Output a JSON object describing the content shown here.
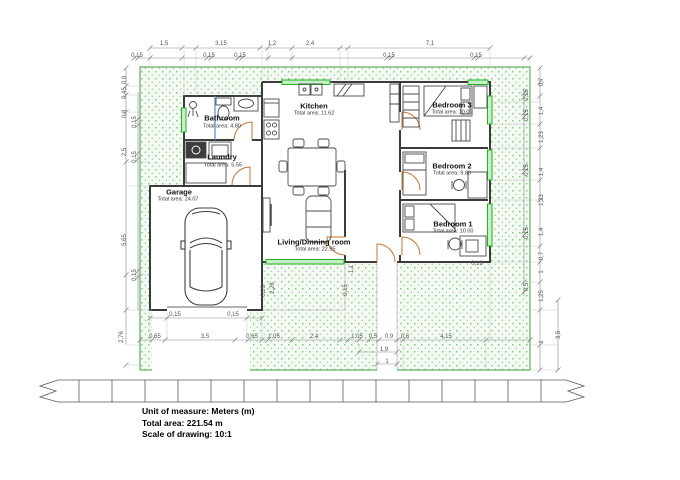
{
  "drawing": {
    "rooms": [
      {
        "name": "Bathroom",
        "area": "Total area: 4.80"
      },
      {
        "name": "Laundry",
        "area": "Total area: 5.55"
      },
      {
        "name": "Garage",
        "area": "Total area: 24.07"
      },
      {
        "name": "Kitchen",
        "area": "Total area: 11.62"
      },
      {
        "name": "Living/Dinning room",
        "area": "Total area: 22.95"
      },
      {
        "name": "Bedroom 3",
        "area": "Total area: 10.00"
      },
      {
        "name": "Bedroom 2",
        "area": "Total area: 9.80"
      },
      {
        "name": "Bedroom 1",
        "area": "Total area: 10.00"
      }
    ],
    "dims": {
      "top1": [
        "1,5",
        "3,15",
        "1,2",
        "2,4",
        "7,1"
      ],
      "top2": [
        "0,15",
        "0,15",
        "0,15",
        "0,15",
        "0,15"
      ],
      "left_outer": [
        "0,9",
        "0,45",
        "0,8",
        "2,5",
        "5,65",
        "2,76"
      ],
      "left_inner": [
        "0,15",
        "0,15",
        "0,15"
      ],
      "right_inner": [
        "0,15",
        "0,15",
        "0,15",
        "0,15",
        "0,5"
      ],
      "right_outer": [
        "0,7",
        "1,4",
        "1,23",
        "1,4",
        "1,23",
        "1,4",
        "0,7",
        "1",
        "1,25",
        "1"
      ],
      "far_right": [
        "3,5"
      ],
      "bottom1": [
        "0,15",
        "0,15"
      ],
      "bottom2": [
        "0,65",
        "3,5",
        "0,65",
        "1,05",
        "2,4",
        "1,05",
        "0,5",
        "0,9",
        "0,6",
        "4,15"
      ],
      "bottom3": [
        "1,9"
      ],
      "bottom4": [
        "1"
      ],
      "detail": [
        "2,28",
        "0,16",
        "1,1",
        "0,15",
        "0,18"
      ]
    },
    "info": {
      "line1": "Unit of measure: Meters (m)",
      "line2": "Total area: 221.54 m",
      "line3": "Scale of drawing: 10:1"
    },
    "colors": {
      "hatch_dot": "#66bb66",
      "window_green": "#1db41d",
      "wall": "#3b3b3b",
      "door_arc": "#c6752b",
      "dim_line": "#8c8c8c",
      "pipe_blue": "#5a93d5"
    }
  }
}
